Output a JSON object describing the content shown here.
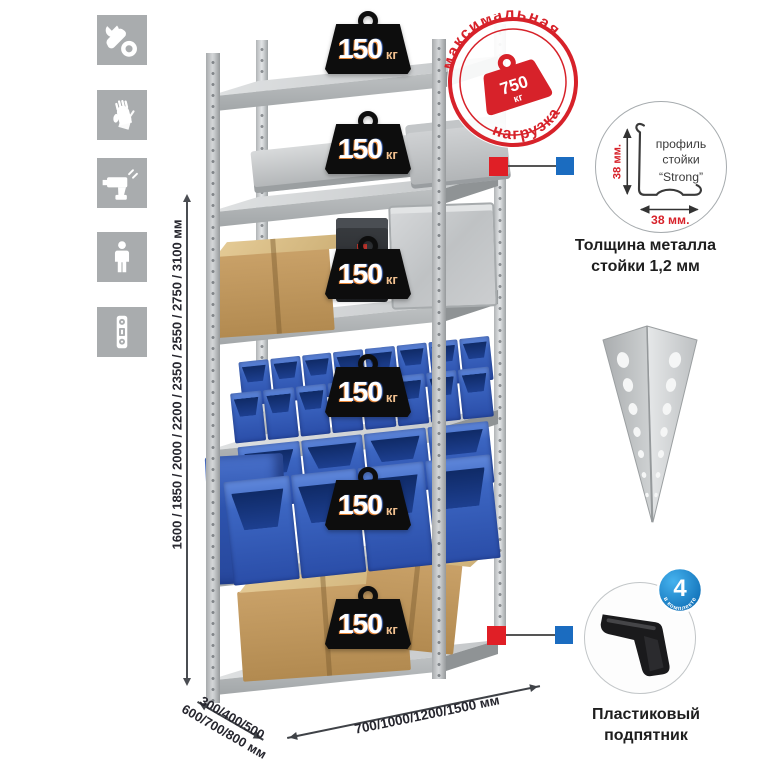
{
  "colors": {
    "stamp_red": "#d7222a",
    "callout_red": "#e01f26",
    "callout_blue": "#1b6cc0",
    "bin_blue": "#3c66c2",
    "icon_gray": "#a9acae",
    "kettlebell_black": "#0d0d0d"
  },
  "left_icons": [
    {
      "name": "wrench"
    },
    {
      "name": "gloves"
    },
    {
      "name": "drill"
    },
    {
      "name": "person"
    },
    {
      "name": "level"
    }
  ],
  "rack": {
    "load_badges": [
      {
        "value": "150",
        "unit": "кг"
      },
      {
        "value": "150",
        "unit": "кг"
      },
      {
        "value": "150",
        "unit": "кг"
      },
      {
        "value": "150",
        "unit": "кг"
      },
      {
        "value": "150",
        "unit": "кг"
      },
      {
        "value": "150",
        "unit": "кг"
      }
    ]
  },
  "stamp": {
    "arc_top": "максимальная",
    "arc_bottom": "нагрузка",
    "weight_value": "750",
    "weight_unit": "кг"
  },
  "profile_detail": {
    "dim_vertical": "38 мм.",
    "dim_horizontal": "38 мм.",
    "label_line1": "профиль",
    "label_line2": "стойки",
    "label_line3": "“Strong”",
    "caption_line1": "Толщина металла",
    "caption_line2": "стойки 1,2 мм"
  },
  "foot_detail": {
    "badge_number": "4",
    "badge_arc": "в комплекте",
    "caption_line1": "Пластиковый",
    "caption_line2": "подпятник"
  },
  "dimensions": {
    "height": "1600 / 1850 / 2000 / 2200 / 2350 / 2550 / 2750 / 3100 мм",
    "depth_line1": "300/400/500",
    "depth_line2": "600/700/800 мм",
    "width": "700/1000/1200/1500 мм"
  }
}
